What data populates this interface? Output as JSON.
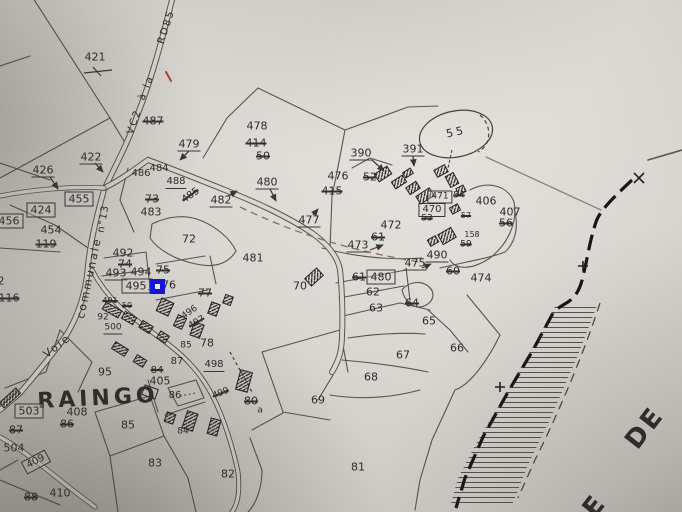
{
  "map": {
    "settlement_name": "RAINGO",
    "neighbor_text_fragment": "DE",
    "road_names": [
      "VC2 à la RD85",
      "Voie communale n°13"
    ],
    "colors": {
      "paper": "#dad7d2",
      "ink": "#3a3733",
      "red_mark": "#b3403a",
      "cursor_blue": "#1414dd",
      "boundary_black": "#171614"
    },
    "cursor": {
      "x": 150,
      "y": 279,
      "size": 15,
      "color": "#1414dd",
      "inner_color": "#eceaf2"
    }
  },
  "labels": [
    {
      "text": "421",
      "x": 95,
      "y": 57
    },
    {
      "text": "487",
      "x": 153,
      "y": 121,
      "style": "s"
    },
    {
      "text": "479",
      "x": 189,
      "y": 145,
      "style": "u"
    },
    {
      "text": "422",
      "x": 91,
      "y": 158,
      "style": "u"
    },
    {
      "text": "426",
      "x": 43,
      "y": 171,
      "style": "u"
    },
    {
      "text": "486",
      "x": 141,
      "y": 174,
      "size": 10
    },
    {
      "text": "484",
      "x": 159,
      "y": 169,
      "size": 10
    },
    {
      "text": "488",
      "x": 176,
      "y": 183,
      "style": "u",
      "size": 10
    },
    {
      "text": "485",
      "x": 191,
      "y": 196,
      "rot": -35,
      "style": "s",
      "size": 10
    },
    {
      "text": "482",
      "x": 221,
      "y": 201,
      "style": "u"
    },
    {
      "text": "480",
      "x": 267,
      "y": 183,
      "style": "u"
    },
    {
      "text": "455",
      "x": 79,
      "y": 199,
      "style": "b"
    },
    {
      "text": "424",
      "x": 41,
      "y": 210,
      "style": "b"
    },
    {
      "text": "456",
      "x": 9,
      "y": 221,
      "style": "b"
    },
    {
      "text": "454",
      "x": 51,
      "y": 230
    },
    {
      "text": "119",
      "x": 46,
      "y": 244,
      "style": "s"
    },
    {
      "text": "452",
      "x": -6,
      "y": 281
    },
    {
      "text": "116",
      "x": 9,
      "y": 298,
      "style": "s"
    },
    {
      "text": "73",
      "x": 152,
      "y": 199,
      "style": "s"
    },
    {
      "text": "483",
      "x": 151,
      "y": 212
    },
    {
      "text": "478",
      "x": 257,
      "y": 126
    },
    {
      "text": "414",
      "x": 256,
      "y": 143,
      "style": "s"
    },
    {
      "text": "50",
      "x": 263,
      "y": 156,
      "style": "s"
    },
    {
      "text": "476",
      "x": 338,
      "y": 176
    },
    {
      "text": "52",
      "x": 370,
      "y": 177,
      "style": "s"
    },
    {
      "text": "415",
      "x": 332,
      "y": 191,
      "style": "s"
    },
    {
      "text": "390",
      "x": 361,
      "y": 154,
      "style": "u"
    },
    {
      "text": "391",
      "x": 413,
      "y": 150,
      "style": "u"
    },
    {
      "text": "55",
      "x": 456,
      "y": 132,
      "rot": -12,
      "spacing": 3
    },
    {
      "text": "471",
      "x": 440,
      "y": 197,
      "style": "b",
      "size": 9
    },
    {
      "text": "54",
      "x": 459,
      "y": 196,
      "style": "s",
      "size": 9
    },
    {
      "text": "470",
      "x": 432,
      "y": 210,
      "style": "b",
      "size": 10
    },
    {
      "text": "53",
      "x": 427,
      "y": 219,
      "style": "s",
      "size": 9
    },
    {
      "text": "57",
      "x": 466,
      "y": 216,
      "style": "s",
      "size": 8
    },
    {
      "text": "158",
      "x": 472,
      "y": 235,
      "size": 8
    },
    {
      "text": "59",
      "x": 466,
      "y": 245,
      "style": "s",
      "size": 9
    },
    {
      "text": "406",
      "x": 486,
      "y": 201
    },
    {
      "text": "407",
      "x": 510,
      "y": 212
    },
    {
      "text": "56",
      "x": 506,
      "y": 223,
      "style": "s"
    },
    {
      "text": "490",
      "x": 437,
      "y": 256,
      "style": "u"
    },
    {
      "text": "60",
      "x": 453,
      "y": 271,
      "style": "s"
    },
    {
      "text": "474",
      "x": 481,
      "y": 278
    },
    {
      "text": "472",
      "x": 391,
      "y": 225
    },
    {
      "text": "61",
      "x": 378,
      "y": 237,
      "style": "s"
    },
    {
      "text": "473",
      "x": 358,
      "y": 246,
      "style": "u"
    },
    {
      "text": "477",
      "x": 309,
      "y": 221,
      "style": "u"
    },
    {
      "text": "475",
      "x": 415,
      "y": 264,
      "style": "u"
    },
    {
      "text": "481",
      "x": 253,
      "y": 258
    },
    {
      "text": "72",
      "x": 189,
      "y": 239
    },
    {
      "text": "492",
      "x": 123,
      "y": 253
    },
    {
      "text": "74",
      "x": 125,
      "y": 264,
      "style": "s"
    },
    {
      "text": "493",
      "x": 116,
      "y": 274,
      "style": "u"
    },
    {
      "text": "494",
      "x": 141,
      "y": 273,
      "style": "u"
    },
    {
      "text": "75",
      "x": 163,
      "y": 270,
      "style": "s"
    },
    {
      "text": "495",
      "x": 136,
      "y": 286,
      "style": "b"
    },
    {
      "text": "76",
      "x": 169,
      "y": 285
    },
    {
      "text": "77",
      "x": 205,
      "y": 293,
      "style": "s"
    },
    {
      "text": "VC2",
      "x": 135,
      "y": 122,
      "rot": -70,
      "size": 10,
      "spacing": 2
    },
    {
      "text": "à la",
      "x": 147,
      "y": 88,
      "rot": -68,
      "size": 10,
      "spacing": 2
    },
    {
      "text": "RD85",
      "x": 167,
      "y": 27,
      "rot": -72,
      "size": 10,
      "spacing": 2
    },
    {
      "text": "Voie",
      "x": 57,
      "y": 346,
      "rot": -38,
      "size": 11,
      "spacing": 2
    },
    {
      "text": "communale",
      "x": 89,
      "y": 278,
      "rot": -78,
      "size": 11,
      "spacing": 2
    },
    {
      "text": "n°13",
      "x": 104,
      "y": 219,
      "rot": -80,
      "size": 10,
      "spacing": 1
    },
    {
      "text": "491",
      "x": 110,
      "y": 301,
      "style": "s",
      "size": 8
    },
    {
      "text": "50",
      "x": 127,
      "y": 306,
      "style": "s",
      "size": 8
    },
    {
      "text": "92",
      "x": 103,
      "y": 318,
      "size": 9
    },
    {
      "text": "500",
      "x": 113,
      "y": 329,
      "style": "u",
      "size": 9
    },
    {
      "text": "496",
      "x": 190,
      "y": 313,
      "rot": -35,
      "size": 9
    },
    {
      "text": "497",
      "x": 197,
      "y": 323,
      "rot": -30,
      "style": "s",
      "size": 9
    },
    {
      "text": "78",
      "x": 207,
      "y": 343
    },
    {
      "text": "85",
      "x": 186,
      "y": 346,
      "size": 9
    },
    {
      "text": "87",
      "x": 177,
      "y": 362,
      "size": 10
    },
    {
      "text": "84",
      "x": 157,
      "y": 371,
      "style": "s",
      "size": 10
    },
    {
      "text": "405",
      "x": 160,
      "y": 381
    },
    {
      "text": "95",
      "x": 105,
      "y": 372
    },
    {
      "text": "RAINGO",
      "x": 98,
      "y": 399,
      "size": 22,
      "rot": -3,
      "spacing": 4,
      "weight": 600
    },
    {
      "text": "503",
      "x": 29,
      "y": 411,
      "style": "b"
    },
    {
      "text": "408",
      "x": 77,
      "y": 412
    },
    {
      "text": "86",
      "x": 67,
      "y": 424,
      "style": "s"
    },
    {
      "text": "87",
      "x": 16,
      "y": 430,
      "style": "s"
    },
    {
      "text": "504",
      "x": 14,
      "y": 448
    },
    {
      "text": "409",
      "x": 36,
      "y": 462,
      "rot": -28,
      "style": "b",
      "size": 10
    },
    {
      "text": "85",
      "x": 128,
      "y": 425
    },
    {
      "text": "83",
      "x": 155,
      "y": 463
    },
    {
      "text": "410",
      "x": 60,
      "y": 493
    },
    {
      "text": "88",
      "x": 31,
      "y": 497,
      "style": "s"
    },
    {
      "text": "86",
      "x": 175,
      "y": 396,
      "size": 10
    },
    {
      "text": "498",
      "x": 214,
      "y": 366,
      "style": "u",
      "size": 10
    },
    {
      "text": "499",
      "x": 221,
      "y": 394,
      "rot": -22,
      "style": "s",
      "size": 9
    },
    {
      "text": "80",
      "x": 251,
      "y": 401,
      "style": "s"
    },
    {
      "text": "a",
      "x": 260,
      "y": 411,
      "size": 9
    },
    {
      "text": "84",
      "x": 183,
      "y": 432,
      "size": 9
    },
    {
      "text": "82",
      "x": 228,
      "y": 474
    },
    {
      "text": "81",
      "x": 358,
      "y": 467
    },
    {
      "text": "69",
      "x": 318,
      "y": 400
    },
    {
      "text": "68",
      "x": 371,
      "y": 377
    },
    {
      "text": "67",
      "x": 403,
      "y": 355
    },
    {
      "text": "66",
      "x": 457,
      "y": 348
    },
    {
      "text": "65",
      "x": 429,
      "y": 321
    },
    {
      "text": "64",
      "x": 412,
      "y": 303,
      "style": "s"
    },
    {
      "text": "63",
      "x": 376,
      "y": 308
    },
    {
      "text": "62",
      "x": 373,
      "y": 292
    },
    {
      "text": "61",
      "x": 359,
      "y": 277,
      "style": "s"
    },
    {
      "text": "480",
      "x": 381,
      "y": 277,
      "style": "b"
    },
    {
      "text": "70",
      "x": 300,
      "y": 286
    },
    {
      "text": "DE",
      "x": 645,
      "y": 428,
      "rot": -52,
      "size": 26,
      "spacing": 3,
      "weight": 600
    },
    {
      "text": "E",
      "x": 594,
      "y": 507,
      "rot": -52,
      "size": 26,
      "weight": 600
    }
  ]
}
